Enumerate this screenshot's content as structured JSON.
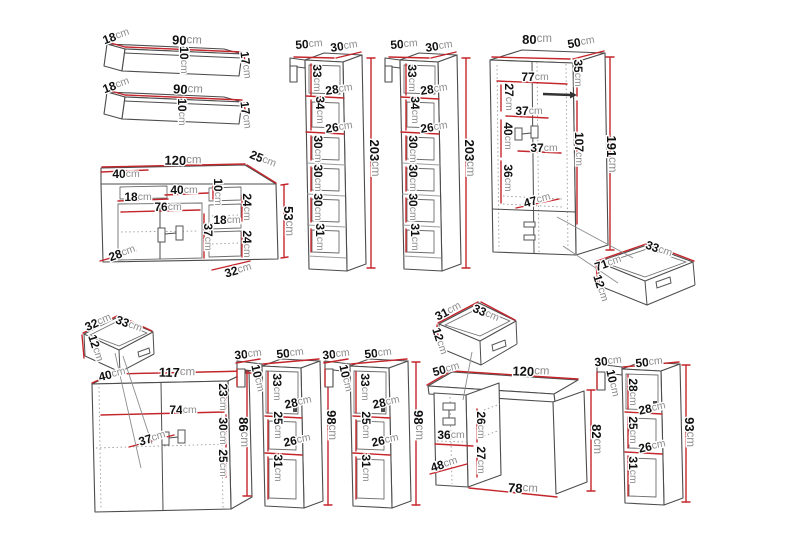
{
  "units": "cm",
  "colors": {
    "dimension_line": "#c4262c",
    "outline": "#4c4c4c",
    "number_text": "#101010",
    "unit_text": "#8d8d8d",
    "background": "#ffffff"
  },
  "furniture_items": [
    {
      "id": "wall-shelf-top",
      "width_cm": 90,
      "depth_cm": 18,
      "height_cm": 17,
      "inner_cm": [
        10
      ]
    },
    {
      "id": "wall-shelf-bottom",
      "width_cm": 90,
      "depth_cm": 18,
      "height_cm": 17,
      "inner_cm": [
        10
      ]
    },
    {
      "id": "tv-stand",
      "width_cm": 120,
      "depth_cm": 25,
      "height_cm": 53,
      "inner_cm": [
        40,
        18,
        40,
        10,
        76,
        24,
        18,
        37,
        24,
        28,
        32
      ]
    },
    {
      "id": "tall-cabinet-left",
      "width_cm": 50,
      "depth_cm": 30,
      "height_cm": 203,
      "inner_cm": [
        33,
        28,
        34,
        26,
        30,
        30,
        30,
        31
      ]
    },
    {
      "id": "tall-cabinet-right",
      "width_cm": 50,
      "depth_cm": 30,
      "height_cm": 203,
      "inner_cm": [
        33,
        28,
        34,
        26,
        30,
        30,
        30,
        31
      ]
    },
    {
      "id": "wardrobe",
      "width_cm": 80,
      "depth_cm": 50,
      "height_cm": 191,
      "inner_cm": [
        35,
        77,
        27,
        37,
        40,
        107,
        37,
        36,
        47
      ]
    },
    {
      "id": "wardrobe-drawer",
      "width_cm": 71,
      "depth_cm": 33,
      "height_cm": 12
    },
    {
      "id": "small-drawer",
      "width_cm": 32,
      "depth_cm": 33,
      "height_cm": 12
    },
    {
      "id": "sideboard",
      "width_cm": 117,
      "depth_cm": 40,
      "height_cm": 86,
      "inner_cm": [
        23,
        74,
        30,
        37,
        25
      ]
    },
    {
      "id": "hanging-cabinet-1",
      "width_cm": 50,
      "depth_cm": 30,
      "height_cm": 98,
      "inner_cm": [
        10,
        33,
        28,
        25,
        26,
        31
      ]
    },
    {
      "id": "hanging-cabinet-2",
      "width_cm": 50,
      "depth_cm": 30,
      "height_cm": 98,
      "inner_cm": [
        10,
        33,
        28,
        25,
        26,
        31
      ]
    },
    {
      "id": "desk-drawer",
      "width_cm": 31,
      "depth_cm": 33,
      "height_cm": 12
    },
    {
      "id": "desk",
      "width_cm": 120,
      "depth_cm": 50,
      "height_cm": 82,
      "inner_cm": [
        26,
        36,
        27,
        48,
        78
      ]
    },
    {
      "id": "hanging-cabinet-3",
      "width_cm": 50,
      "depth_cm": 30,
      "height_cm": 93,
      "inner_cm": [
        10,
        28,
        28,
        25,
        26,
        31
      ]
    }
  ],
  "dimension_labels": [
    {
      "v": "18",
      "u": "cm",
      "x": 116,
      "y": 36,
      "r": -20
    },
    {
      "v": "90",
      "u": "cm",
      "x": 187,
      "y": 40,
      "r": 3,
      "s": 13
    },
    {
      "v": "10",
      "u": "cm",
      "x": 184,
      "y": 60,
      "r": 90
    },
    {
      "v": "17",
      "u": "cm",
      "x": 246,
      "y": 65,
      "r": 83
    },
    {
      "v": "18",
      "u": "cm",
      "x": 116,
      "y": 85,
      "r": -20
    },
    {
      "v": "90",
      "u": "cm",
      "x": 188,
      "y": 89,
      "r": 3,
      "s": 13
    },
    {
      "v": "10",
      "u": "cm",
      "x": 182,
      "y": 112,
      "r": 90
    },
    {
      "v": "17",
      "u": "cm",
      "x": 246,
      "y": 115,
      "r": 83
    },
    {
      "v": "120",
      "u": "cm",
      "x": 183,
      "y": 160,
      "r": 1,
      "s": 13
    },
    {
      "v": "25",
      "u": "cm",
      "x": 263,
      "y": 159,
      "r": 22
    },
    {
      "v": "40",
      "u": "cm",
      "x": 126,
      "y": 174,
      "r": 0
    },
    {
      "v": "18",
      "u": "cm",
      "x": 138,
      "y": 197,
      "r": 0
    },
    {
      "v": "40",
      "u": "cm",
      "x": 184,
      "y": 190,
      "r": 0
    },
    {
      "v": "10",
      "u": "cm",
      "x": 218,
      "y": 192,
      "r": 90
    },
    {
      "v": "76",
      "u": "cm",
      "x": 168,
      "y": 207,
      "r": 0
    },
    {
      "v": "24",
      "u": "cm",
      "x": 247,
      "y": 207,
      "r": 90
    },
    {
      "v": "18",
      "u": "cm",
      "x": 227,
      "y": 220,
      "r": 0
    },
    {
      "v": "37",
      "u": "cm",
      "x": 208,
      "y": 237,
      "r": 90
    },
    {
      "v": "24",
      "u": "cm",
      "x": 247,
      "y": 244,
      "r": 90
    },
    {
      "v": "28",
      "u": "cm",
      "x": 122,
      "y": 253,
      "r": -20
    },
    {
      "v": "32",
      "u": "cm",
      "x": 238,
      "y": 270,
      "r": -16
    },
    {
      "v": "53",
      "u": "cm",
      "x": 289,
      "y": 221,
      "r": 90,
      "s": 13
    },
    {
      "v": "50",
      "u": "cm",
      "x": 309,
      "y": 44,
      "r": -4
    },
    {
      "v": "30",
      "u": "cm",
      "x": 344,
      "y": 46,
      "r": -8
    },
    {
      "v": "33",
      "u": "cm",
      "x": 317,
      "y": 78,
      "r": 90
    },
    {
      "v": "28",
      "u": "cm",
      "x": 339,
      "y": 89,
      "r": -8
    },
    {
      "v": "34",
      "u": "cm",
      "x": 320,
      "y": 110,
      "r": 90
    },
    {
      "v": "26",
      "u": "cm",
      "x": 339,
      "y": 127,
      "r": -8
    },
    {
      "v": "30",
      "u": "cm",
      "x": 318,
      "y": 149,
      "r": 90
    },
    {
      "v": "30",
      "u": "cm",
      "x": 318,
      "y": 178,
      "r": 90
    },
    {
      "v": "30",
      "u": "cm",
      "x": 318,
      "y": 207,
      "r": 90
    },
    {
      "v": "31",
      "u": "cm",
      "x": 320,
      "y": 237,
      "r": 90
    },
    {
      "v": "203",
      "u": "cm",
      "x": 375,
      "y": 158,
      "r": 90,
      "s": 13
    },
    {
      "v": "50",
      "u": "cm",
      "x": 404,
      "y": 44,
      "r": -4
    },
    {
      "v": "30",
      "u": "cm",
      "x": 439,
      "y": 46,
      "r": -8
    },
    {
      "v": "33",
      "u": "cm",
      "x": 412,
      "y": 78,
      "r": 90
    },
    {
      "v": "28",
      "u": "cm",
      "x": 434,
      "y": 89,
      "r": -8
    },
    {
      "v": "34",
      "u": "cm",
      "x": 415,
      "y": 110,
      "r": 90
    },
    {
      "v": "26",
      "u": "cm",
      "x": 434,
      "y": 127,
      "r": -8
    },
    {
      "v": "30",
      "u": "cm",
      "x": 413,
      "y": 149,
      "r": 90
    },
    {
      "v": "30",
      "u": "cm",
      "x": 413,
      "y": 178,
      "r": 90
    },
    {
      "v": "30",
      "u": "cm",
      "x": 413,
      "y": 207,
      "r": 90
    },
    {
      "v": "31",
      "u": "cm",
      "x": 415,
      "y": 237,
      "r": 90
    },
    {
      "v": "203",
      "u": "cm",
      "x": 470,
      "y": 158,
      "r": 90,
      "s": 13
    },
    {
      "v": "80",
      "u": "cm",
      "x": 537,
      "y": 39,
      "r": 0,
      "s": 13
    },
    {
      "v": "50",
      "u": "cm",
      "x": 581,
      "y": 42,
      "r": -10
    },
    {
      "v": "35",
      "u": "cm",
      "x": 578,
      "y": 73,
      "r": 90
    },
    {
      "v": "77",
      "u": "cm",
      "x": 535,
      "y": 77,
      "r": 0
    },
    {
      "v": "27",
      "u": "cm",
      "x": 509,
      "y": 97,
      "r": 90
    },
    {
      "v": "37",
      "u": "cm",
      "x": 529,
      "y": 111,
      "r": 0
    },
    {
      "v": "40",
      "u": "cm",
      "x": 508,
      "y": 136,
      "r": 90
    },
    {
      "v": "107",
      "u": "cm",
      "x": 579,
      "y": 149,
      "r": 90
    },
    {
      "v": "37",
      "u": "cm",
      "x": 544,
      "y": 148,
      "r": 0
    },
    {
      "v": "36",
      "u": "cm",
      "x": 508,
      "y": 178,
      "r": 90
    },
    {
      "v": "47",
      "u": "cm",
      "x": 537,
      "y": 200,
      "r": -16
    },
    {
      "v": "191",
      "u": "cm",
      "x": 612,
      "y": 154,
      "r": 90,
      "s": 13
    },
    {
      "v": "33",
      "u": "cm",
      "x": 659,
      "y": 249,
      "r": 20
    },
    {
      "v": "71",
      "u": "cm",
      "x": 608,
      "y": 263,
      "r": -19
    },
    {
      "v": "12",
      "u": "cm",
      "x": 601,
      "y": 288,
      "r": 73
    },
    {
      "v": "32",
      "u": "cm",
      "x": 98,
      "y": 322,
      "r": -24
    },
    {
      "v": "33",
      "u": "cm",
      "x": 129,
      "y": 324,
      "r": 21
    },
    {
      "v": "12",
      "u": "cm",
      "x": 96,
      "y": 348,
      "r": 73
    },
    {
      "v": "40",
      "u": "cm",
      "x": 112,
      "y": 374,
      "r": -14
    },
    {
      "v": "117",
      "u": "cm",
      "x": 177,
      "y": 372,
      "r": 1,
      "s": 13
    },
    {
      "v": "23",
      "u": "cm",
      "x": 223,
      "y": 397,
      "r": 90
    },
    {
      "v": "74",
      "u": "cm",
      "x": 183,
      "y": 410,
      "r": 0
    },
    {
      "v": "30",
      "u": "cm",
      "x": 223,
      "y": 431,
      "r": 90
    },
    {
      "v": "37",
      "u": "cm",
      "x": 152,
      "y": 438,
      "r": -17
    },
    {
      "v": "25",
      "u": "cm",
      "x": 223,
      "y": 463,
      "r": 90
    },
    {
      "v": "86",
      "u": "cm",
      "x": 244,
      "y": 432,
      "r": 90,
      "s": 13
    },
    {
      "v": "30",
      "u": "cm",
      "x": 248,
      "y": 354,
      "r": -6
    },
    {
      "v": "50",
      "u": "cm",
      "x": 290,
      "y": 353,
      "r": -6
    },
    {
      "v": "10",
      "u": "cm",
      "x": 258,
      "y": 378,
      "r": 78
    },
    {
      "v": "33",
      "u": "cm",
      "x": 277,
      "y": 387,
      "r": 90
    },
    {
      "v": "28",
      "u": "cm",
      "x": 298,
      "y": 402,
      "r": -12
    },
    {
      "v": "25",
      "u": "cm",
      "x": 278,
      "y": 425,
      "r": 90
    },
    {
      "v": "26",
      "u": "cm",
      "x": 297,
      "y": 440,
      "r": -12
    },
    {
      "v": "31",
      "u": "cm",
      "x": 278,
      "y": 468,
      "r": 90
    },
    {
      "v": "98",
      "u": "cm",
      "x": 332,
      "y": 425,
      "r": 90,
      "s": 13
    },
    {
      "v": "30",
      "u": "cm",
      "x": 336,
      "y": 354,
      "r": -6
    },
    {
      "v": "50",
      "u": "cm",
      "x": 378,
      "y": 353,
      "r": -6
    },
    {
      "v": "10",
      "u": "cm",
      "x": 346,
      "y": 378,
      "r": 78
    },
    {
      "v": "33",
      "u": "cm",
      "x": 365,
      "y": 387,
      "r": 90
    },
    {
      "v": "28",
      "u": "cm",
      "x": 386,
      "y": 402,
      "r": -12
    },
    {
      "v": "25",
      "u": "cm",
      "x": 366,
      "y": 425,
      "r": 90
    },
    {
      "v": "26",
      "u": "cm",
      "x": 385,
      "y": 440,
      "r": -12
    },
    {
      "v": "31",
      "u": "cm",
      "x": 366,
      "y": 468,
      "r": 90
    },
    {
      "v": "98",
      "u": "cm",
      "x": 419,
      "y": 425,
      "r": 90,
      "s": 13
    },
    {
      "v": "31",
      "u": "cm",
      "x": 448,
      "y": 311,
      "r": -27
    },
    {
      "v": "33",
      "u": "cm",
      "x": 486,
      "y": 313,
      "r": 23
    },
    {
      "v": "12",
      "u": "cm",
      "x": 440,
      "y": 341,
      "r": 73
    },
    {
      "v": "50",
      "u": "cm",
      "x": 446,
      "y": 369,
      "r": -15
    },
    {
      "v": "120",
      "u": "cm",
      "x": 531,
      "y": 371,
      "r": 2,
      "s": 13
    },
    {
      "v": "26",
      "u": "cm",
      "x": 481,
      "y": 425,
      "r": 90
    },
    {
      "v": "36",
      "u": "cm",
      "x": 451,
      "y": 435,
      "r": 0
    },
    {
      "v": "27",
      "u": "cm",
      "x": 481,
      "y": 460,
      "r": 90
    },
    {
      "v": "48",
      "u": "cm",
      "x": 444,
      "y": 464,
      "r": -17
    },
    {
      "v": "78",
      "u": "cm",
      "x": 523,
      "y": 488,
      "r": 4,
      "s": 13
    },
    {
      "v": "82",
      "u": "cm",
      "x": 597,
      "y": 439,
      "r": 90,
      "s": 13
    },
    {
      "v": "30",
      "u": "cm",
      "x": 608,
      "y": 361,
      "r": -6
    },
    {
      "v": "50",
      "u": "cm",
      "x": 649,
      "y": 362,
      "r": -6
    },
    {
      "v": "10",
      "u": "cm",
      "x": 613,
      "y": 383,
      "r": 78
    },
    {
      "v": "28",
      "u": "cm",
      "x": 633,
      "y": 392,
      "r": 90
    },
    {
      "v": "28",
      "u": "cm",
      "x": 652,
      "y": 408,
      "r": -12
    },
    {
      "v": "25",
      "u": "cm",
      "x": 633,
      "y": 430,
      "r": 90
    },
    {
      "v": "26",
      "u": "cm",
      "x": 652,
      "y": 446,
      "r": -12
    },
    {
      "v": "31",
      "u": "cm",
      "x": 633,
      "y": 470,
      "r": 90
    },
    {
      "v": "93",
      "u": "cm",
      "x": 690,
      "y": 432,
      "r": 90,
      "s": 13
    }
  ]
}
